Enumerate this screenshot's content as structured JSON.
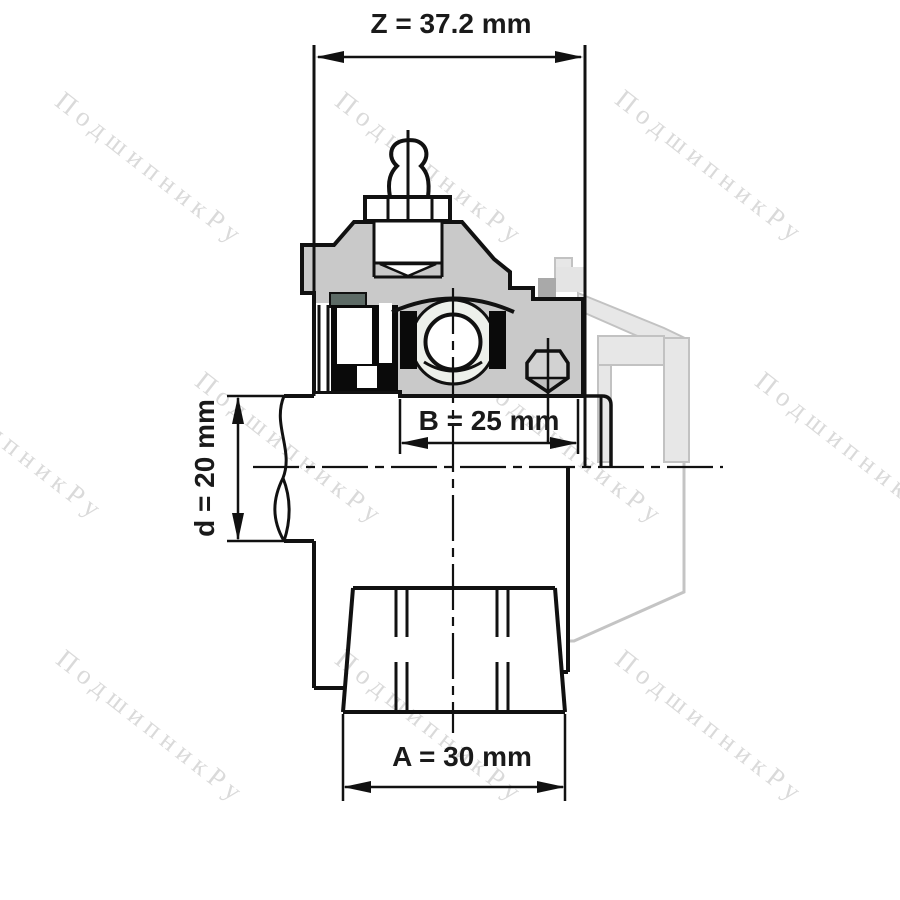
{
  "title": "Bearing insert unit cross-section drawing",
  "watermark": {
    "text": "ПодшипникРу"
  },
  "dimensions": {
    "Z": {
      "label": "Z = 37.2 mm",
      "value_mm": 37.2,
      "orientation": "horizontal-top"
    },
    "B": {
      "label": "B = 25 mm",
      "value_mm": 25,
      "orientation": "horizontal-middle"
    },
    "d": {
      "label": "d = 20 mm",
      "value_mm": 20,
      "orientation": "vertical-left"
    },
    "A": {
      "label": "A = 30 mm",
      "value_mm": 30,
      "orientation": "horizontal-bottom"
    }
  },
  "colors": {
    "line": "#111111",
    "housing_fill": "#c9c9c9",
    "seal_fill": "#0a0a0a",
    "raceway_fill": "#edf0eb",
    "setscrew_fill": "#d2d2d2",
    "teal_detail": "#5d6b66",
    "phantom_fill": "#e7e7e7",
    "phantom_stroke": "#c2c2c2",
    "watermark": "#dadada"
  }
}
